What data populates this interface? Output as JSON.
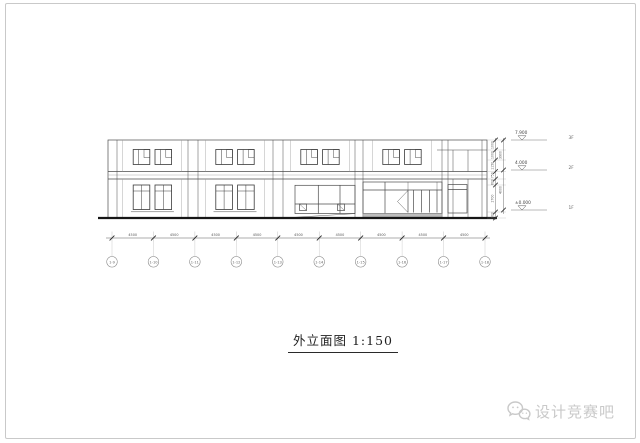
{
  "title": {
    "text": "外立面图 1:150"
  },
  "watermark": {
    "icon": "wechat-chat-bubbles",
    "text": "设计竞赛吧"
  },
  "elevation_markers": [
    {
      "value": "7.900",
      "floor_label": "3F"
    },
    {
      "value": "4.000",
      "floor_label": "2F"
    },
    {
      "value": "±0.000",
      "floor_label": "1F"
    }
  ],
  "axis_grid": {
    "bubble_labels": [
      "1-9",
      "1-10",
      "1-11",
      "1-12",
      "1-13",
      "1-14",
      "1-15",
      "1-16",
      "1-17",
      "1-18"
    ]
  },
  "dimensions": {
    "horizontal_segments": [
      "4500",
      "4500",
      "4500",
      "4500",
      "4500",
      "4500",
      "4500",
      "4500",
      "4500"
    ],
    "vertical_inner_segments": [
      "1000",
      "1000",
      "1150",
      "750",
      "600",
      "2700",
      "600"
    ],
    "vertical_outer_segments": [
      "3900",
      "4000"
    ]
  },
  "colors": {
    "line": "#4b4b4b",
    "light_line": "#9a9a9a",
    "dark_line": "#2a2a2a",
    "ground": "#161616",
    "dim_text": "#555555",
    "frame": "#c9c9c9",
    "watermark": "#c9c9c9",
    "steps_fill": "#bdbdbd"
  }
}
